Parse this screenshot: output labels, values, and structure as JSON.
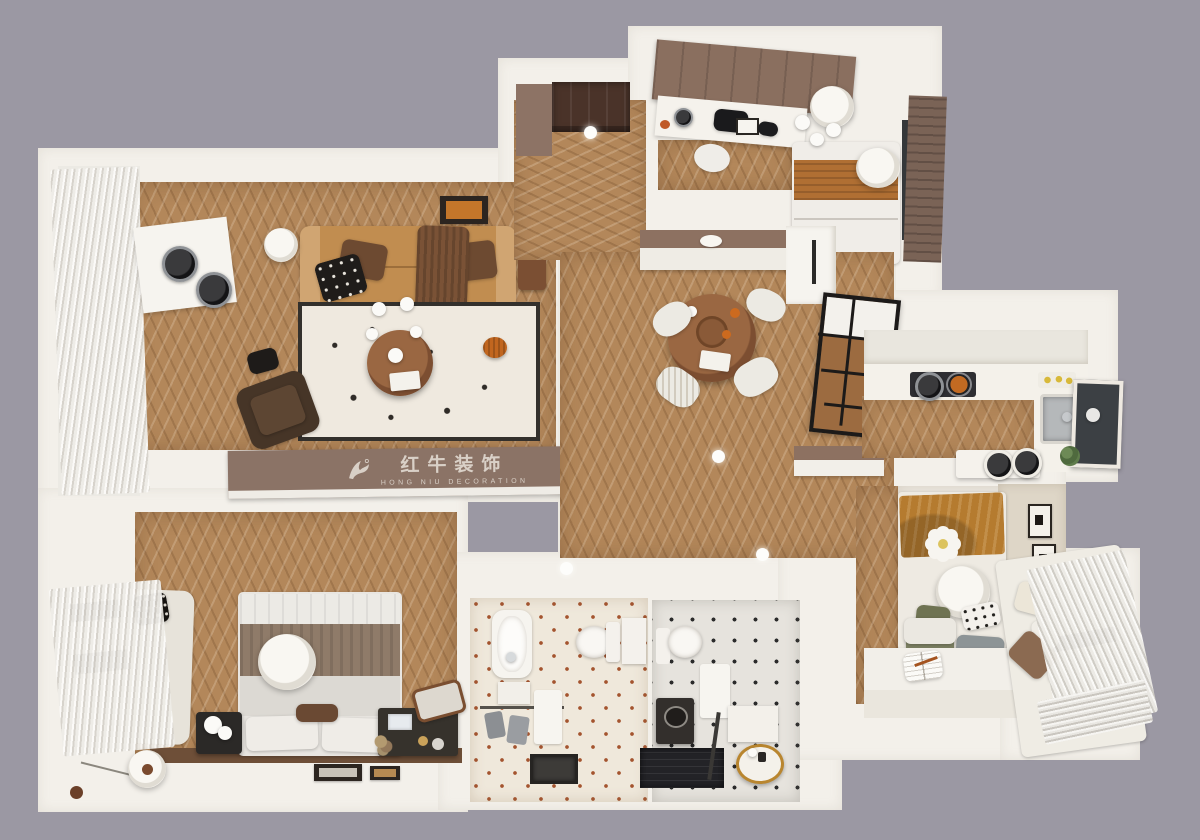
{
  "watermark": {
    "cn": "红牛装饰",
    "en": "HONG NIU DECORATION",
    "logo": "bull-icon"
  },
  "palette": {
    "bg": "#9b98a3",
    "wall": "#f3f0ea",
    "wood": "#b3875a",
    "woodDark": "#8f6a42",
    "sofa": "#c18d50",
    "banner": "#8b7366",
    "bannerText": "#d9d0c7",
    "rug": "#efe9df",
    "rugBorder": "#33302c",
    "walnut": "#8a583a",
    "caramel": "#b06f33",
    "taupe": "#8f7b69",
    "mustard": "#b57b2f",
    "tileBase": "#efe8db",
    "tileAccent": "#a4542f",
    "shower": "#232327",
    "curtain": "#eeece7"
  }
}
